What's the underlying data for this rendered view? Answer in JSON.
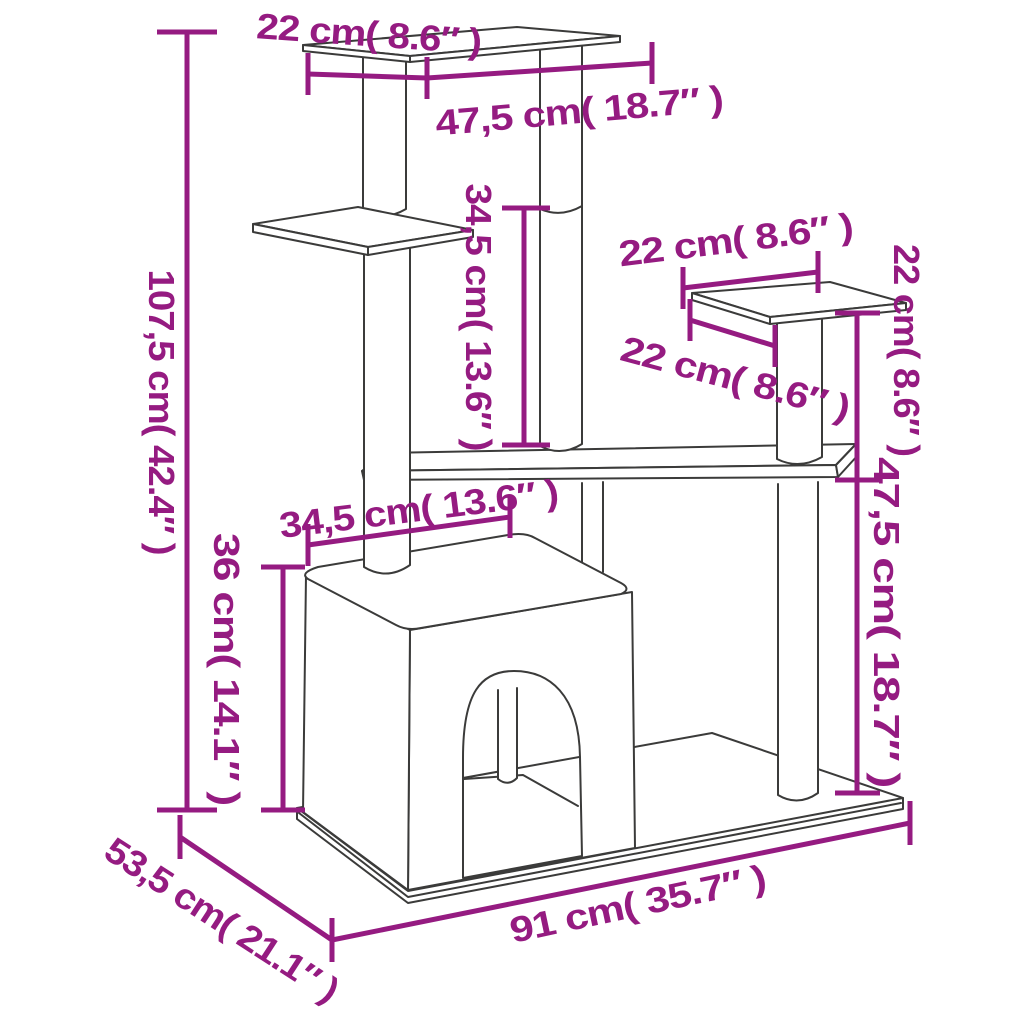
{
  "diagram": {
    "type": "product-dimension-diagram",
    "subject": "Cat tree with scratching posts and condo",
    "colors": {
      "background": "#ffffff",
      "outline": "#3b3b3a",
      "dimension": "#951b81"
    },
    "labels": {
      "top_platform_depth": "22 cm( 8.6″ )",
      "top_platform_width": "47,5 cm( 18.7″ )",
      "upper_post_height": "34,5 cm( 13.6″ )",
      "right_platform_width": "22 cm( 8.6″ )",
      "right_platform_depth": "22 cm( 8.6″ )",
      "right_platform_height": "22 cm( 8.6″ )",
      "total_height": "107,5 cm( 42.4″ )",
      "condo_width": "34,5 cm( 13.6″ )",
      "condo_height": "36 cm( 14.1″ )",
      "lower_right_height": "47,5 cm( 18.7″ )",
      "base_length": "91 cm( 35.7″ )",
      "base_depth": "53,5 cm( 21.1″ )"
    }
  }
}
